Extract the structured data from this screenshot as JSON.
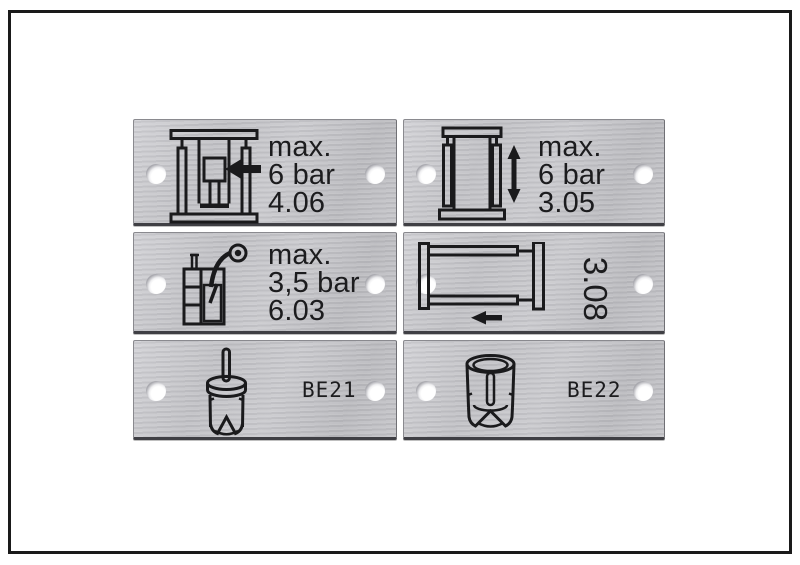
{
  "figure": {
    "description": "Six brushed aluminium marking plates with two mounting holes each, arranged in two columns and three rows inside a black photo frame",
    "frame_color": "#1a1a1a",
    "background": "#ffffff"
  },
  "colors": {
    "plate_metal_light": "#d3d3d7",
    "plate_metal_dark": "#bcbcc0",
    "plate_edge": "#8a8a8f",
    "plate_edge_bottom": "#3f3f44",
    "ink": "#1c1c1e",
    "hole_white": "#ffffff"
  },
  "plates": [
    {
      "position": "row1-left",
      "icon": "press-clamp-icon",
      "lines": [
        "max.",
        "6 bar",
        "4.06"
      ]
    },
    {
      "position": "row1-right",
      "icon": "vertical-stroke-frame-icon",
      "lines": [
        "max.",
        "6 bar",
        "3.05"
      ]
    },
    {
      "position": "row2-left",
      "icon": "spray-tank-icon",
      "lines": [
        "max.",
        "3,5 bar",
        "6.03"
      ]
    },
    {
      "position": "row2-right",
      "icon": "horizontal-slide-frame-icon",
      "rotated_code": "3.08"
    },
    {
      "position": "row3-left",
      "icon": "pin-sleeve-icon",
      "code": "BE21"
    },
    {
      "position": "row3-right",
      "icon": "socket-sleeve-icon",
      "code": "BE22"
    }
  ]
}
